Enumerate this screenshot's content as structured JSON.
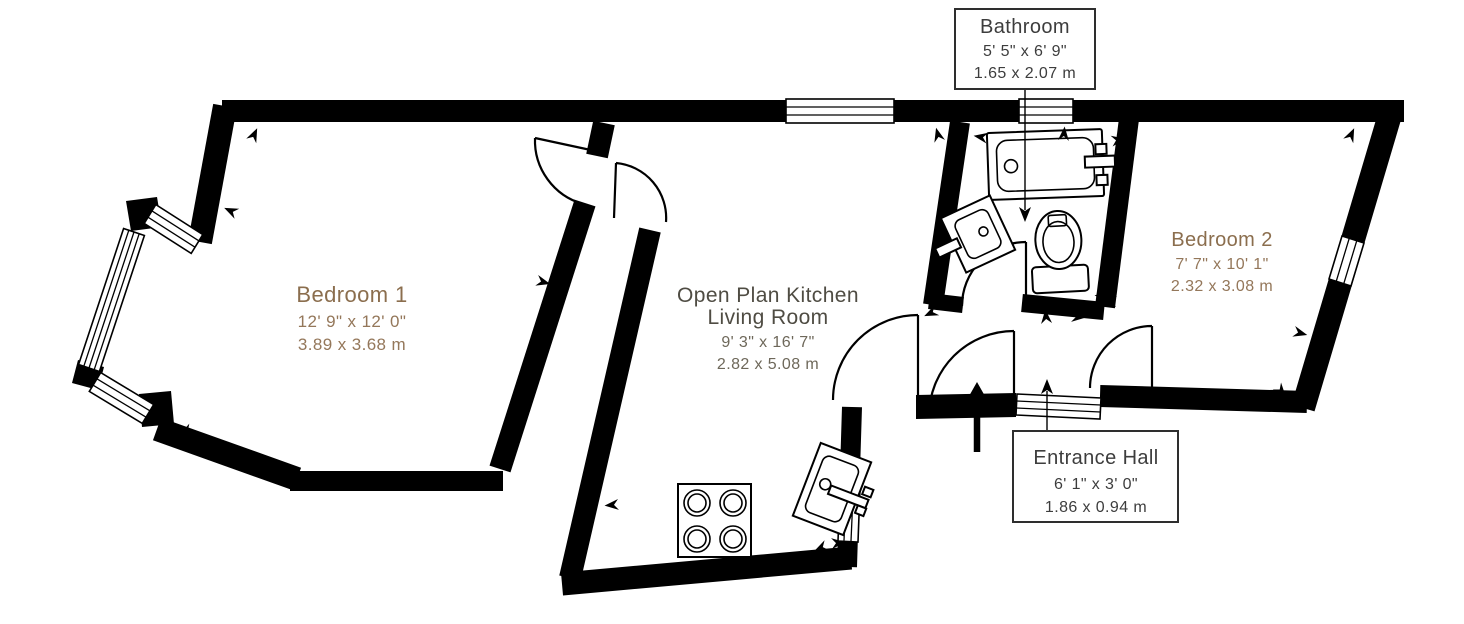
{
  "plan": {
    "background": "#ffffff",
    "wall_color": "#000000",
    "rooms": {
      "bedroom1": {
        "name": "Bedroom 1",
        "imperial": "12' 9\" x 12' 0\"",
        "metric": "3.89 x 3.68 m"
      },
      "living": {
        "line1": "Open Plan Kitchen",
        "line2": "Living Room",
        "imperial": "9' 3\" x 16' 7\"",
        "metric": "2.82 x 5.08 m"
      },
      "bedroom2": {
        "name": "Bedroom 2",
        "imperial": "7' 7\" x 10' 1\"",
        "metric": "2.32 x 3.08 m"
      },
      "bathroom": {
        "name": "Bathroom",
        "imperial": "5' 5\" x 6' 9\"",
        "metric": "1.65 x 2.07 m"
      },
      "entrance": {
        "name": "Entrance Hall",
        "imperial": "6' 1\" x 3' 0\"",
        "metric": "1.86 x 0.94 m"
      }
    },
    "colors": {
      "bedroom_label": "#8b6e4e",
      "bedroom_dims": "#94775a",
      "living_label": "#4f4c43",
      "living_dims": "#6e685a",
      "callout_text": "#3d3d3d"
    },
    "icons": [
      "bathtub-icon",
      "toilet-icon",
      "bathroom-sink-icon",
      "kitchen-sink-icon",
      "hob-icon",
      "entry-arrow-icon",
      "direction-arrow-icon"
    ]
  }
}
